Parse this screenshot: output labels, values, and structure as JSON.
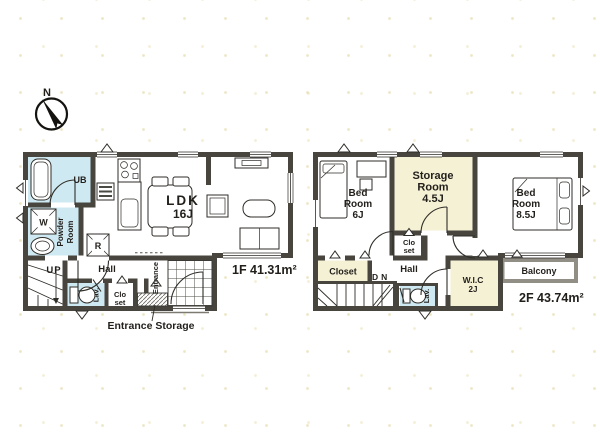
{
  "colors": {
    "wall": "#47453e",
    "water": "#cfe9f2",
    "cream": "#f5f1d5",
    "ink": "#221f1b",
    "balcony_wall": "#918e85"
  },
  "compass": {
    "north_label": "N"
  },
  "floor1": {
    "area_label": "1F 41.31m²",
    "entrance_storage_label": "Entrance Storage",
    "rooms": {
      "ub": {
        "label": "UB"
      },
      "powder_room": {
        "lines": [
          "Powder",
          "Room"
        ]
      },
      "ldk": {
        "lines": [
          "LDK",
          "16J"
        ]
      },
      "stairs": {
        "label": "UP"
      },
      "hall": {
        "label": "Hall"
      },
      "lav": {
        "label": "Lav."
      },
      "closet": {
        "lines": [
          "Clo",
          "set"
        ]
      },
      "entrance": {
        "label": "Entrance"
      }
    },
    "symbols": {
      "washing_machine": "W",
      "refrigerator": "R"
    }
  },
  "floor2": {
    "area_label": "2F 43.74m²",
    "rooms": {
      "bedroom_6": {
        "lines": [
          "Bed",
          "Room",
          "6J"
        ]
      },
      "storage_room": {
        "lines": [
          "Storage",
          "Room",
          "4.5J"
        ]
      },
      "bedroom_85": {
        "lines": [
          "Bed",
          "Room",
          "8.5J"
        ]
      },
      "small_closet": {
        "lines": [
          "Clo",
          "set"
        ]
      },
      "closet": {
        "label": "Closet"
      },
      "stairs": {
        "label": "DN"
      },
      "hall": {
        "label": "Hall"
      },
      "lav": {
        "label": "Lav."
      },
      "wic": {
        "lines": [
          "W.I.C",
          "2J"
        ]
      },
      "balcony": {
        "label": "Balcony"
      }
    }
  }
}
